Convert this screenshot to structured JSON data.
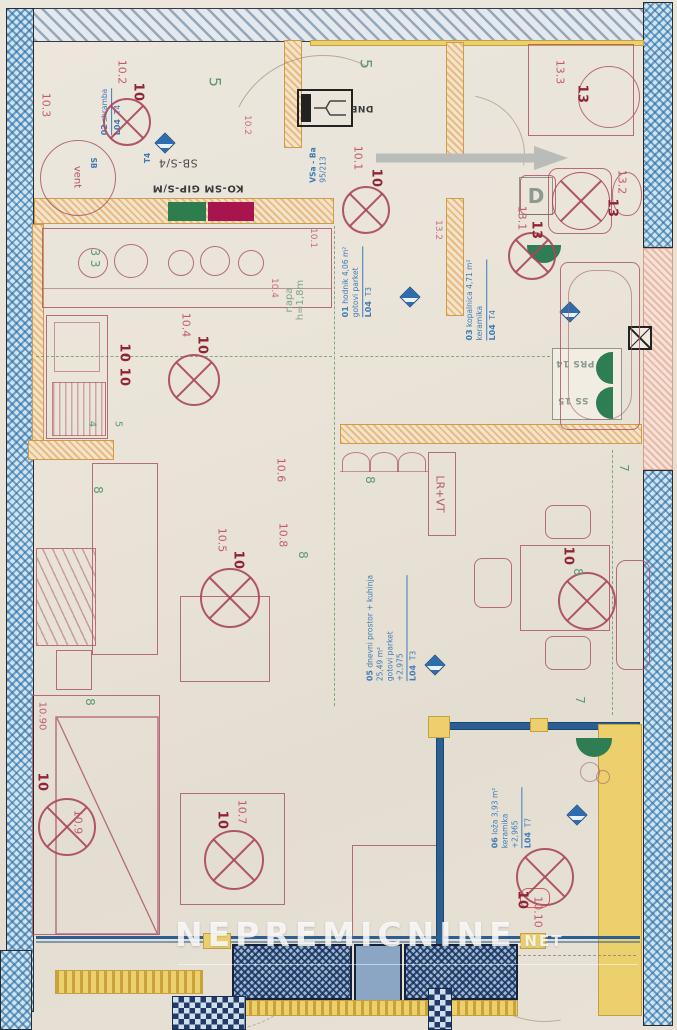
{
  "watermark": {
    "name": "NEPREMICNINE",
    "tld": ".NET"
  },
  "colors": {
    "wall_blue": "#2a6ca0",
    "wall_orange": "#cf9b45",
    "furniture_red": "#ad566b",
    "stamp_red": "#8e2436",
    "note_blue": "#3f7ab5",
    "mark_green": "#5a9a6e",
    "swatch_green": "#2e7d4f",
    "swatch_crimson": "#a8154e"
  },
  "construction_labels": {
    "sb_panel": "SB-S/4",
    "ko_sm": "KO-SM GIP-S/M",
    "dne": "DNE",
    "d_door": "D",
    "prs": "PRS 14",
    "ss": "SS 15",
    "lr_vt": "LR+VT",
    "vent": "vent",
    "sb": "SB",
    "napa": "napa",
    "napa_h": "h=1,8m",
    "vsa": "VSa - Ba",
    "vsa_num": "95/213",
    "t4": "T4"
  },
  "room_notes": [
    {
      "num": "02",
      "name": "shramba",
      "area": "",
      "finish": "",
      "elev": "",
      "code": "L04",
      "tag": "T4"
    },
    {
      "num": "01",
      "name": "hodnik",
      "area": "4,06 m²",
      "finish": "gotovi parket",
      "elev": "",
      "code": "L04",
      "tag": "T3"
    },
    {
      "num": "03",
      "name": "kopalnica",
      "area": "4,71 m²",
      "finish": "keramika",
      "elev": "",
      "code": "L04",
      "tag": "T4"
    },
    {
      "num": "05",
      "name": "dnevni prostor + kuhinja",
      "area": "25,49 m²",
      "finish": "gotovi parket",
      "elev": "+2,975",
      "code": "L04",
      "tag": "T3"
    },
    {
      "num": "06",
      "name": "loža",
      "area": "3,93 m²",
      "finish": "keramika",
      "elev": "+2,965",
      "code": "L04",
      "tag": "T7"
    }
  ],
  "lights": [
    {
      "label": "10.2",
      "stamp": "10"
    },
    {
      "label": "10.3",
      "stamp": ""
    },
    {
      "label": "10.1",
      "stamp": "10"
    },
    {
      "label": "10.1",
      "stamp": ""
    },
    {
      "label": "10.2",
      "stamp": ""
    },
    {
      "label": "10.4",
      "stamp": "10"
    },
    {
      "label": "10.4",
      "stamp": ""
    },
    {
      "label": "10.5",
      "stamp": "10"
    },
    {
      "label": "10.6",
      "stamp": ""
    },
    {
      "label": "10.8",
      "stamp": ""
    },
    {
      "label": "10.7",
      "stamp": "10"
    },
    {
      "label": "10.9",
      "stamp": "10"
    },
    {
      "label": "10.10",
      "stamp": "10"
    },
    {
      "label": "",
      "stamp": "10"
    },
    {
      "label": "13.1",
      "stamp": "13"
    },
    {
      "label": "13.2",
      "stamp": "13"
    },
    {
      "label": "13.2",
      "stamp": ""
    },
    {
      "label": "13.3",
      "stamp": "13"
    },
    {
      "label": "10.90",
      "stamp": ""
    },
    {
      "label": "",
      "stamp": "10 10"
    }
  ],
  "green_marks": {
    "m1": "5",
    "m2": "5",
    "m3": "3 3",
    "m4": "4",
    "m5": "5",
    "m6": "8",
    "m7": "8",
    "m8": "8",
    "m9": "7",
    "m10": "7",
    "m11": "8",
    "m12": "8"
  }
}
